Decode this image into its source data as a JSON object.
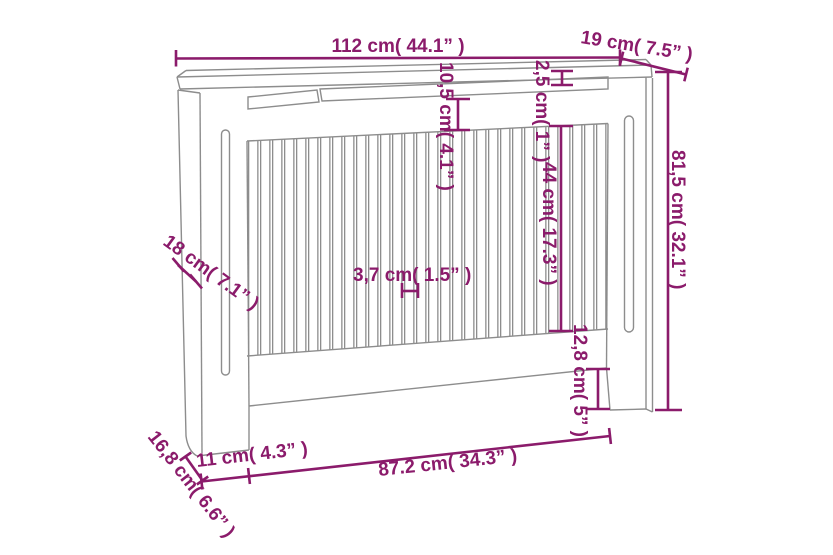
{
  "figure": {
    "subject": "radiator-cover-dimension-drawing"
  },
  "colors": {
    "dimension": "#8B1B6B",
    "line": "#8D8D8D",
    "background": "#FFFFFF"
  },
  "dims": {
    "overall_width": "112 cm( 44.1” )",
    "top_depth": "19 cm( 7.5” )",
    "top_rail_height": "10,5 cm( 4.1” )",
    "top_thickness": "2,5 cm( 1” )",
    "slat_height": "44 cm( 17.3” )",
    "overall_height": "81,5 cm( 32.1” )",
    "side_depth": "18 cm( 7.1” )",
    "slat_spacing": "3,7 cm( 1.5” )",
    "cutout_height": "12,8 cm( 5” )",
    "foot_width": "11 cm( 4.3” )",
    "bottom_width": "87.2 cm( 34.3” )",
    "bottom_depth": "16,8 cm( 6.6” )"
  }
}
